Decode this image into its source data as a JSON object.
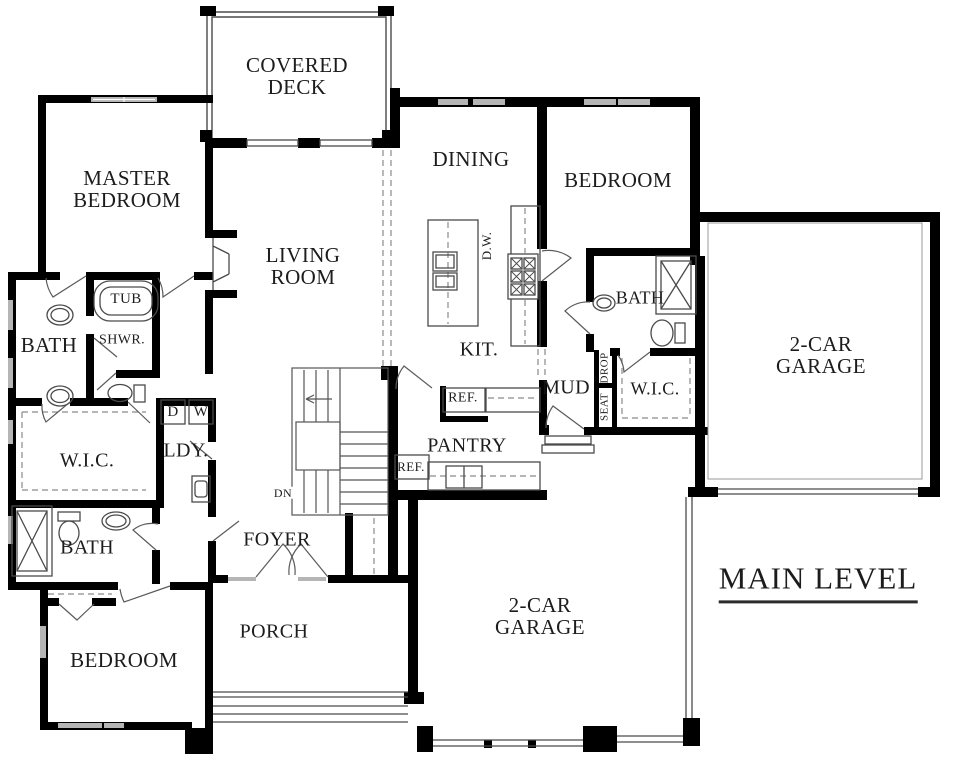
{
  "plan_title": "MAIN LEVEL",
  "labels": {
    "covered_deck": "COVERED DECK",
    "master_bedroom": "MASTER BEDROOM",
    "living_room": "LIVING ROOM",
    "dining": "DINING",
    "bedroom_right": "BEDROOM",
    "bedroom_lower": "BEDROOM",
    "bath_master": "BATH",
    "tub": "TUB",
    "shwr": "SHWR.",
    "wic_master": "W.I.C.",
    "wic_right": "W.I.C.",
    "ldy": "LDY.",
    "dryer": "D",
    "washer": "W",
    "bath_lower": "BATH",
    "bath_right": "BATH",
    "foyer": "FOYER",
    "porch": "PORCH",
    "kitchen": "KIT.",
    "dishwasher": "D.W.",
    "ref_upper": "REF.",
    "ref_lower": "REF.",
    "pantry": "PANTRY",
    "mud": "MUD",
    "drop": "DROP",
    "seat": "SEAT",
    "garage_right": "2-CAR GARAGE",
    "garage_bottom": "2-CAR GARAGE",
    "stairs_dn": "DN"
  },
  "colors": {
    "wall": "#000000",
    "thin_line": "#4a4a4a",
    "dashed_line": "#8a8a8a",
    "window": "#b5b5b5",
    "text": "#1c1c1c"
  }
}
